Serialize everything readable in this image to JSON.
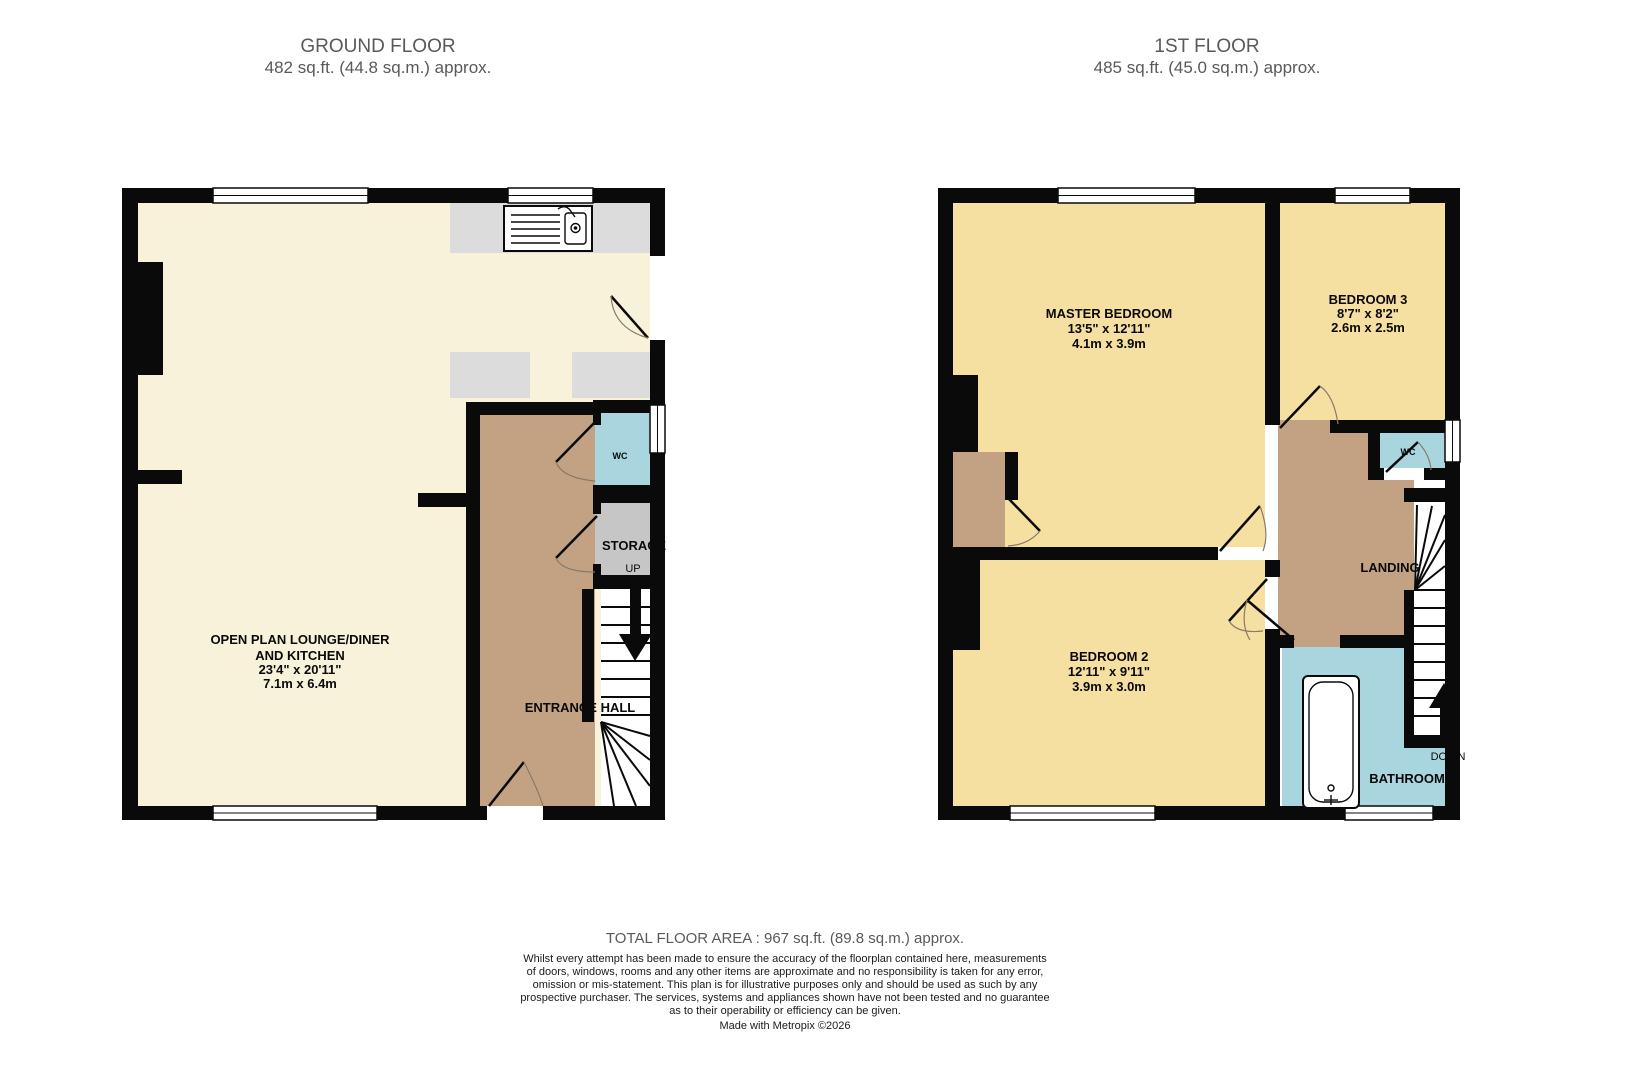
{
  "ground_floor": {
    "title": "GROUND FLOOR",
    "area": "482 sq.ft. (44.8 sq.m.) approx.",
    "rooms": {
      "open_plan": {
        "line1": "OPEN PLAN LOUNGE/DINER",
        "line2": "AND KITCHEN",
        "dims_imperial": "23'4\"  x 20'11\"",
        "dims_metric": "7.1m  x 6.4m"
      },
      "entrance_hall": {
        "name": "ENTRANCE HALL"
      },
      "wc": {
        "name": "WC"
      },
      "storage": {
        "name": "STORAGE"
      }
    },
    "stair_label": "UP"
  },
  "first_floor": {
    "title": "1ST FLOOR",
    "area": "485 sq.ft. (45.0 sq.m.) approx.",
    "rooms": {
      "master": {
        "name": "MASTER BEDROOM",
        "dims_imperial": "13'5\"  x 12'11\"",
        "dims_metric": "4.1m  x 3.9m"
      },
      "bedroom3": {
        "name": "BEDROOM 3",
        "dims_imperial": "8'7\"  x 8'2\"",
        "dims_metric": "2.6m  x 2.5m"
      },
      "bedroom2": {
        "name": "BEDROOM 2",
        "dims_imperial": "12'11\"  x 9'11\"",
        "dims_metric": "3.9m  x 3.0m"
      },
      "landing": {
        "name": "LANDING"
      },
      "bathroom": {
        "name": "BATHROOM"
      },
      "wc": {
        "name": "WC"
      }
    },
    "stair_label": "DOWN"
  },
  "footer": {
    "total_area": "TOTAL FLOOR AREA : 967 sq.ft. (89.8 sq.m.) approx.",
    "disclaimer_lines": [
      "Whilst every attempt has been made to ensure the accuracy of the floorplan contained here, measurements",
      "of doors, windows, rooms and any other items are approximate and no responsibility is taken for any error,",
      "omission or mis-statement. This plan is for illustrative purposes only and should be used as such by any",
      "prospective purchaser. The services, systems and appliances shown have not been tested and no guarantee",
      "as to their operability or efficiency can be given."
    ],
    "credit": "Made with Metropix ©2026"
  },
  "colors": {
    "wall": "#0a0a0a",
    "lounge_cream": "#f8f2da",
    "bedroom_yellow": "#f5dfa1",
    "hall_brown": "#c3a284",
    "wet_blue": "#a9d6de",
    "storage_gray": "#c6c6c6",
    "counter_gray": "#dcdcdc",
    "title_gray": "#58595b",
    "label_black": "#0a0a0a"
  }
}
